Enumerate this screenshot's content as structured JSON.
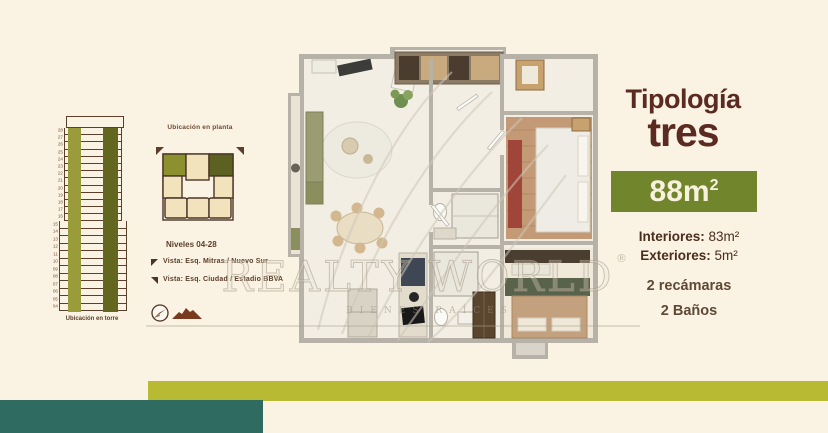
{
  "colors": {
    "bg": "#faf2e3",
    "lime": "#b9ba33",
    "teal": "#2f6b60",
    "badge-green": "#71862c",
    "olive-light": "#9a9c3c",
    "olive-dark": "#63661f",
    "unit-cream": "#f2e3bd",
    "unit-olive": "#8d902f",
    "unit-dark-olive": "#5c6020",
    "title-brown": "#5b2a20"
  },
  "tower": {
    "label": "Ubicación en torre",
    "floors": [
      "28",
      "27",
      "26",
      "25",
      "24",
      "23",
      "22",
      "21",
      "20",
      "19",
      "18",
      "17",
      "16",
      "15",
      "14",
      "13",
      "12",
      "11",
      "10",
      "09",
      "08",
      "07",
      "06",
      "05",
      "04"
    ]
  },
  "locator": {
    "title": "Ubicación en planta",
    "levels": "Niveles 04-28",
    "view1": "Vista: Esq. Mitras / Nuevo Sur",
    "view2": "Vista: Esq. Ciudad / Estadio BBVA"
  },
  "floorplan": {
    "watermark_main": "REALTY WORLD",
    "watermark_reg": "®",
    "watermark_sub": "BIENES RAÍCES"
  },
  "panel": {
    "title": "Tipología",
    "subtitle": "tres",
    "area": "88m",
    "area_sup": "2",
    "spec1_label": "Interiores:",
    "spec1_value": "83m²",
    "spec2_label": "Exteriores:",
    "spec2_value": "5m²",
    "feature1": "2 recámaras",
    "feature2": "2 Baños"
  }
}
